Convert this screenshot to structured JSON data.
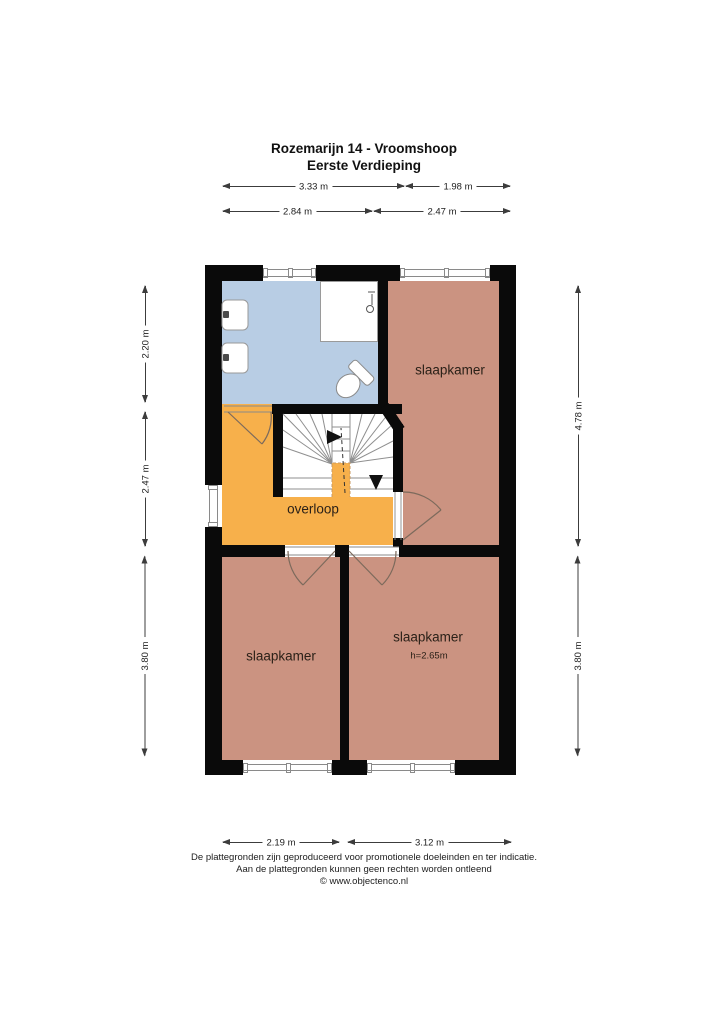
{
  "title": {
    "line1": "Rozemarijn 14 - Vroomshoop",
    "line2": "Eerste Verdieping"
  },
  "rooms": {
    "bedroom_top_right": {
      "label": "slaapkamer"
    },
    "bedroom_bottom_left": {
      "label": "slaapkamer"
    },
    "bedroom_bottom_right": {
      "label": "slaapkamer",
      "height_note": "h=2.65m"
    },
    "landing": {
      "label": "overloop"
    }
  },
  "dimensions": {
    "top_row1": [
      "3.33 m",
      "1.98 m"
    ],
    "top_row2": [
      "2.84 m",
      "2.47 m"
    ],
    "left": [
      "2.20 m",
      "2.47 m",
      "3.80 m"
    ],
    "right": [
      "4.78 m",
      "3.80 m"
    ],
    "bottom": [
      "2.19 m",
      "3.12 m"
    ]
  },
  "footer": {
    "line1": "De plattegronden zijn geproduceerd voor promotionele doeleinden en ter indicatie.",
    "line2": "Aan de plattegronden kunnen geen rechten worden ontleend",
    "line3": "© www.objectenco.nl"
  },
  "colors": {
    "bathroom": "#b8cde4",
    "bedroom": "#cb9381",
    "landing": "#f7b04b",
    "wall": "#0a0a0a",
    "dimline": "#3c3c3c",
    "labeltext": "#2b2118"
  }
}
